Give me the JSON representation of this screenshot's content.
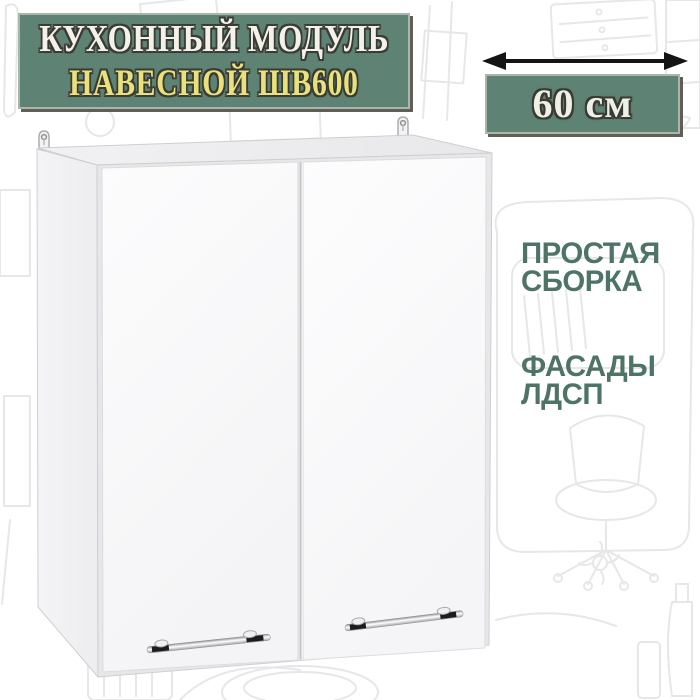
{
  "title_badge": {
    "line1": "КУХОННЫЙ МОДУЛЬ",
    "line2": "НАВЕСНОЙ ШВ600"
  },
  "dimension": {
    "label": "60 см",
    "arrow_icon": "double-headed-horizontal-arrow"
  },
  "features": [
    {
      "line1": "ПРОСТАЯ",
      "line2": "СБОРКА"
    },
    {
      "line1": "ФАСАДЫ",
      "line2": "ЛДСП"
    }
  ],
  "illustration": {
    "name": "white-two-door-wall-cabinet",
    "door_count": 2,
    "handle_count": 2,
    "hanger_count": 2
  },
  "colors": {
    "badge_bg": "#5e8273",
    "badge_border": "#a9b7aa",
    "title_line1": "#f4f2e8",
    "title_line2": "#eae17c",
    "dimension_text": "#eef0e6",
    "feature_text": "#4e7467",
    "text_outline": "#3b3b35",
    "arrow": "#141414",
    "cabinet_door": "#fafafb",
    "cabinet_side": "#f1f1f3",
    "cabinet_top": "#ececef",
    "doodle": "#e7e7e9",
    "background": "#ffffff"
  }
}
